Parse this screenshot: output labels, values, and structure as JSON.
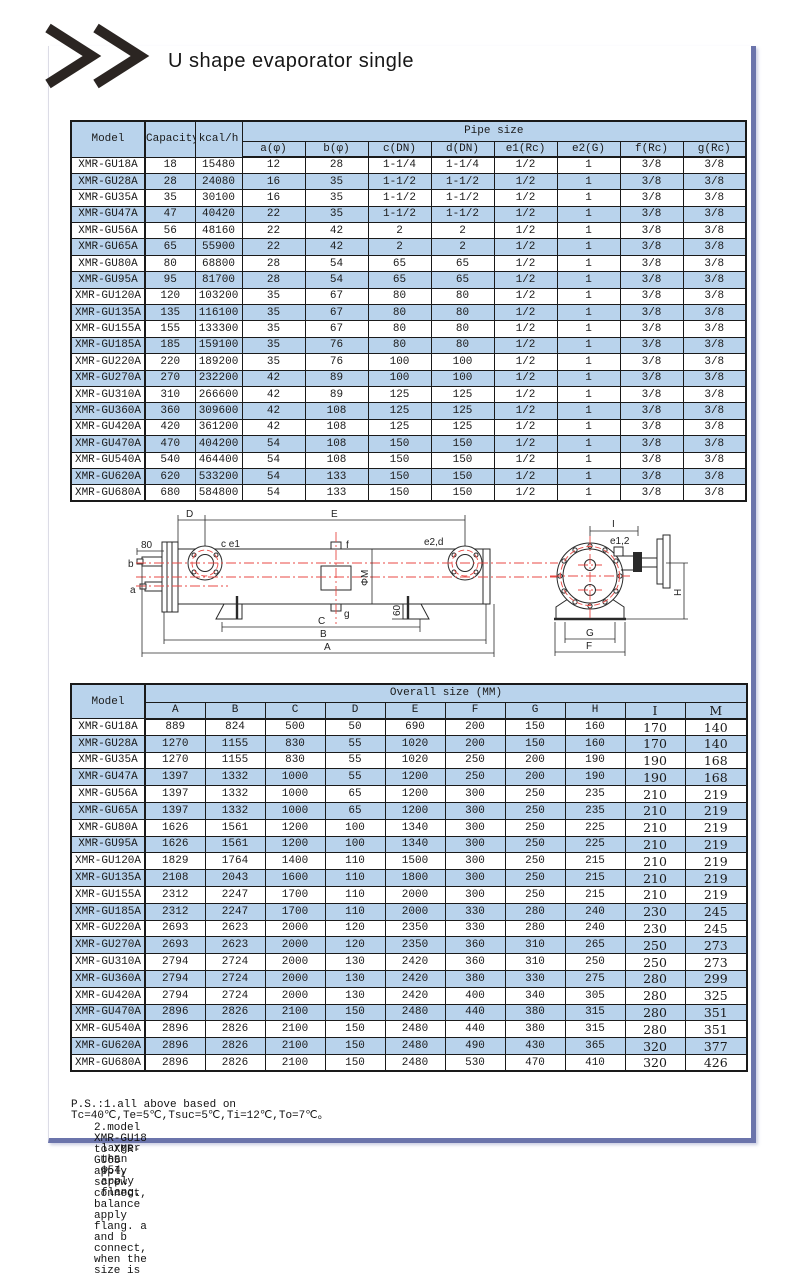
{
  "page": {
    "title": "U shape evaporator single",
    "chevrons": ">>"
  },
  "colors": {
    "table_header_bg": "#b9d3ec",
    "row_alt_bg": "#b9d3ec",
    "frame_blue": "#6b74ab",
    "diagram_red": "#e84a45"
  },
  "table1": {
    "headers": {
      "model": "Model",
      "capacity": "Capacity",
      "kcal": "kcal/h",
      "pipe_size": "Pipe size",
      "sub": [
        "a(φ)",
        "b(φ)",
        "c(DN)",
        "d(DN)",
        "e1(Rc)",
        "e2(G)",
        "f(Rc)",
        "g(Rc)"
      ]
    },
    "rows": [
      [
        "XMR-GU18A",
        "18",
        "15480",
        "12",
        "28",
        "1-1/4",
        "1-1/4",
        "1/2",
        "1",
        "3/8",
        "3/8"
      ],
      [
        "XMR-GU28A",
        "28",
        "24080",
        "16",
        "35",
        "1-1/2",
        "1-1/2",
        "1/2",
        "1",
        "3/8",
        "3/8"
      ],
      [
        "XMR-GU35A",
        "35",
        "30100",
        "16",
        "35",
        "1-1/2",
        "1-1/2",
        "1/2",
        "1",
        "3/8",
        "3/8"
      ],
      [
        "XMR-GU47A",
        "47",
        "40420",
        "22",
        "35",
        "1-1/2",
        "1-1/2",
        "1/2",
        "1",
        "3/8",
        "3/8"
      ],
      [
        "XMR-GU56A",
        "56",
        "48160",
        "22",
        "42",
        "2",
        "2",
        "1/2",
        "1",
        "3/8",
        "3/8"
      ],
      [
        "XMR-GU65A",
        "65",
        "55900",
        "22",
        "42",
        "2",
        "2",
        "1/2",
        "1",
        "3/8",
        "3/8"
      ],
      [
        "XMR-GU80A",
        "80",
        "68800",
        "28",
        "54",
        "65",
        "65",
        "1/2",
        "1",
        "3/8",
        "3/8"
      ],
      [
        "XMR-GU95A",
        "95",
        "81700",
        "28",
        "54",
        "65",
        "65",
        "1/2",
        "1",
        "3/8",
        "3/8"
      ],
      [
        "XMR-GU120A",
        "120",
        "103200",
        "35",
        "67",
        "80",
        "80",
        "1/2",
        "1",
        "3/8",
        "3/8"
      ],
      [
        "XMR-GU135A",
        "135",
        "116100",
        "35",
        "67",
        "80",
        "80",
        "1/2",
        "1",
        "3/8",
        "3/8"
      ],
      [
        "XMR-GU155A",
        "155",
        "133300",
        "35",
        "67",
        "80",
        "80",
        "1/2",
        "1",
        "3/8",
        "3/8"
      ],
      [
        "XMR-GU185A",
        "185",
        "159100",
        "35",
        "76",
        "80",
        "80",
        "1/2",
        "1",
        "3/8",
        "3/8"
      ],
      [
        "XMR-GU220A",
        "220",
        "189200",
        "35",
        "76",
        "100",
        "100",
        "1/2",
        "1",
        "3/8",
        "3/8"
      ],
      [
        "XMR-GU270A",
        "270",
        "232200",
        "42",
        "89",
        "100",
        "100",
        "1/2",
        "1",
        "3/8",
        "3/8"
      ],
      [
        "XMR-GU310A",
        "310",
        "266600",
        "42",
        "89",
        "125",
        "125",
        "1/2",
        "1",
        "3/8",
        "3/8"
      ],
      [
        "XMR-GU360A",
        "360",
        "309600",
        "42",
        "108",
        "125",
        "125",
        "1/2",
        "1",
        "3/8",
        "3/8"
      ],
      [
        "XMR-GU420A",
        "420",
        "361200",
        "42",
        "108",
        "125",
        "125",
        "1/2",
        "1",
        "3/8",
        "3/8"
      ],
      [
        "XMR-GU470A",
        "470",
        "404200",
        "54",
        "108",
        "150",
        "150",
        "1/2",
        "1",
        "3/8",
        "3/8"
      ],
      [
        "XMR-GU540A",
        "540",
        "464400",
        "54",
        "108",
        "150",
        "150",
        "1/2",
        "1",
        "3/8",
        "3/8"
      ],
      [
        "XMR-GU620A",
        "620",
        "533200",
        "54",
        "133",
        "150",
        "150",
        "1/2",
        "1",
        "3/8",
        "3/8"
      ],
      [
        "XMR-GU680A",
        "680",
        "584800",
        "54",
        "133",
        "150",
        "150",
        "1/2",
        "1",
        "3/8",
        "3/8"
      ]
    ]
  },
  "table2": {
    "headers": {
      "model": "Model",
      "overall": "Overall size (MM)",
      "sub": [
        "A",
        "B",
        "C",
        "D",
        "E",
        "F",
        "G",
        "H",
        "I",
        "M"
      ]
    },
    "rows": [
      [
        "XMR-GU18A",
        "889",
        "824",
        "500",
        "50",
        "690",
        "200",
        "150",
        "160",
        "170",
        "140"
      ],
      [
        "XMR-GU28A",
        "1270",
        "1155",
        "830",
        "55",
        "1020",
        "200",
        "150",
        "160",
        "170",
        "140"
      ],
      [
        "XMR-GU35A",
        "1270",
        "1155",
        "830",
        "55",
        "1020",
        "250",
        "200",
        "190",
        "190",
        "168"
      ],
      [
        "XMR-GU47A",
        "1397",
        "1332",
        "1000",
        "55",
        "1200",
        "250",
        "200",
        "190",
        "190",
        "168"
      ],
      [
        "XMR-GU56A",
        "1397",
        "1332",
        "1000",
        "65",
        "1200",
        "300",
        "250",
        "235",
        "210",
        "219"
      ],
      [
        "XMR-GU65A",
        "1397",
        "1332",
        "1000",
        "65",
        "1200",
        "300",
        "250",
        "235",
        "210",
        "219"
      ],
      [
        "XMR-GU80A",
        "1626",
        "1561",
        "1200",
        "100",
        "1340",
        "300",
        "250",
        "225",
        "210",
        "219"
      ],
      [
        "XMR-GU95A",
        "1626",
        "1561",
        "1200",
        "100",
        "1340",
        "300",
        "250",
        "225",
        "210",
        "219"
      ],
      [
        "XMR-GU120A",
        "1829",
        "1764",
        "1400",
        "110",
        "1500",
        "300",
        "250",
        "215",
        "210",
        "219"
      ],
      [
        "XMR-GU135A",
        "2108",
        "2043",
        "1600",
        "110",
        "1800",
        "300",
        "250",
        "215",
        "210",
        "219"
      ],
      [
        "XMR-GU155A",
        "2312",
        "2247",
        "1700",
        "110",
        "2000",
        "300",
        "250",
        "215",
        "210",
        "219"
      ],
      [
        "XMR-GU185A",
        "2312",
        "2247",
        "1700",
        "110",
        "2000",
        "330",
        "280",
        "240",
        "230",
        "245"
      ],
      [
        "XMR-GU220A",
        "2693",
        "2623",
        "2000",
        "120",
        "2350",
        "330",
        "280",
        "240",
        "230",
        "245"
      ],
      [
        "XMR-GU270A",
        "2693",
        "2623",
        "2000",
        "120",
        "2350",
        "360",
        "310",
        "265",
        "250",
        "273"
      ],
      [
        "XMR-GU310A",
        "2794",
        "2724",
        "2000",
        "130",
        "2420",
        "360",
        "310",
        "250",
        "250",
        "273"
      ],
      [
        "XMR-GU360A",
        "2794",
        "2724",
        "2000",
        "130",
        "2420",
        "380",
        "330",
        "275",
        "280",
        "299"
      ],
      [
        "XMR-GU420A",
        "2794",
        "2724",
        "2000",
        "130",
        "2420",
        "400",
        "340",
        "305",
        "280",
        "325"
      ],
      [
        "XMR-GU470A",
        "2896",
        "2826",
        "2100",
        "150",
        "2480",
        "440",
        "380",
        "315",
        "280",
        "351"
      ],
      [
        "XMR-GU540A",
        "2896",
        "2826",
        "2100",
        "150",
        "2480",
        "440",
        "380",
        "315",
        "280",
        "351"
      ],
      [
        "XMR-GU620A",
        "2896",
        "2826",
        "2100",
        "150",
        "2480",
        "490",
        "430",
        "365",
        "320",
        "377"
      ],
      [
        "XMR-GU680A",
        "2896",
        "2826",
        "2100",
        "150",
        "2480",
        "530",
        "470",
        "410",
        "320",
        "426"
      ]
    ]
  },
  "diagram": {
    "side": {
      "d80": "80",
      "b": "b",
      "a": "a",
      "D": "D",
      "E": "E",
      "ce1": "c e1",
      "f": "f",
      "e2d": "e2,d",
      "phiM": "ΦM",
      "g": "g",
      "d60": "60",
      "C": "C",
      "B": "B",
      "A": "A"
    },
    "end": {
      "I": "I",
      "e12": "e1,2",
      "H": "H",
      "G": "G",
      "F": "F"
    }
  },
  "notes": {
    "line1": "P.S.:1.all above based on Tc=40℃,Te=5℃,Tsuc=5℃,Ti=12℃,To=7℃。",
    "line2": "2.model XMR-GU18 to XMR-GU65 apply screw connect, balance apply flang. a and b connect, when the size is",
    "line3": "larger than Φ54, apply flang."
  }
}
